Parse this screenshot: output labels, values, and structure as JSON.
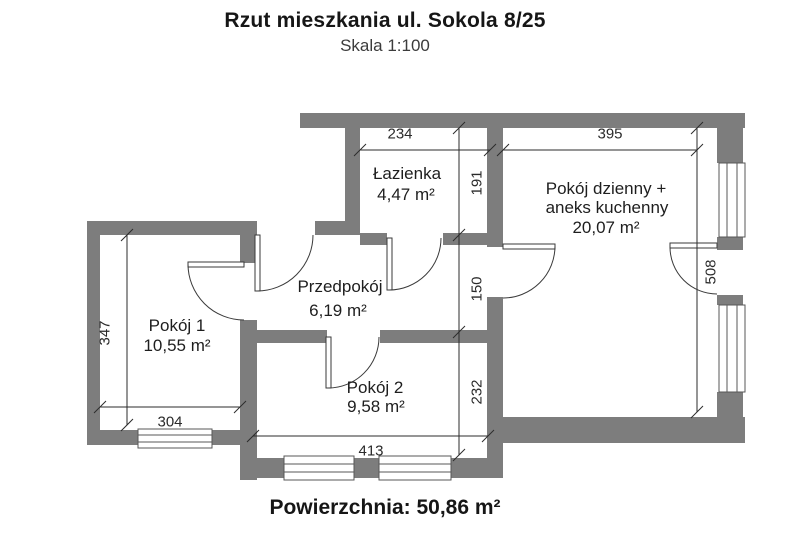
{
  "header": {
    "title": "Rzut mieszkania ul. Sokola 8/25",
    "subtitle": "Skala 1:100"
  },
  "footer": {
    "total_area_label": "Powierzchnia: 50,86 m²"
  },
  "rooms": [
    {
      "name": "Łazienka",
      "area": "4,47 m²"
    },
    {
      "name_lines": [
        "Pokój dzienny +",
        "aneks kuchenny"
      ],
      "area": "20,07 m²"
    },
    {
      "name": "Przedpokój",
      "area": "6,19 m²"
    },
    {
      "name": "Pokój 1",
      "area": "10,55 m²"
    },
    {
      "name": "Pokój 2",
      "area": "9,58 m²"
    }
  ],
  "dimensions_cm": {
    "lazienka_width": "234",
    "living_width": "395",
    "lazienka_height": "191",
    "hall_height": "150",
    "pokoj2_height": "232",
    "living_height": "508",
    "pokoj1_height": "347",
    "pokoj1_width": "304",
    "pokoj2_width": "413"
  },
  "colors": {
    "wall": "#7d7d7d",
    "line": "#3a3a3a",
    "text": "#1e1e1e"
  }
}
